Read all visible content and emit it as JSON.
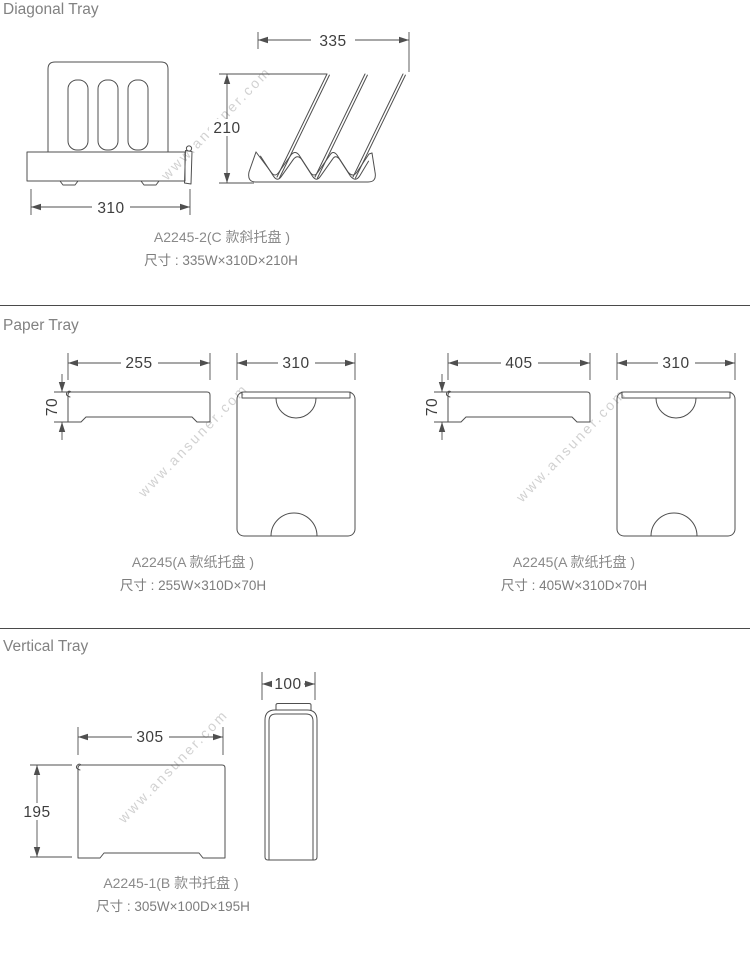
{
  "watermark": {
    "text": "www.ansuner.com"
  },
  "colors": {
    "line": "#4f4f4f",
    "dimension_text": "#3e3e3e",
    "title_text": "#828282",
    "caption_text": "#8a8a8a",
    "watermark": "#c9c9c9",
    "separator": "#4a4a4a",
    "background": "#ffffff"
  },
  "sections": [
    {
      "title": "Diagonal Tray",
      "caption": {
        "model": "A2245-2(C 款斜托盘 )",
        "size": "尺寸 : 335W×310D×210H"
      },
      "dims": {
        "side_width": "335",
        "side_height": "210",
        "front_width": "310"
      }
    },
    {
      "title": "Paper Tray",
      "items": [
        {
          "caption": {
            "model": "A2245(A 款纸托盘 )",
            "size": "尺寸 : 255W×310D×70H"
          },
          "dims": {
            "front_width": "255",
            "front_height": "70",
            "top_width": "310"
          }
        },
        {
          "caption": {
            "model": "A2245(A 款纸托盘 )",
            "size": "尺寸 : 405W×310D×70H"
          },
          "dims": {
            "front_width": "405",
            "front_height": "70",
            "top_width": "310"
          }
        }
      ]
    },
    {
      "title": "Vertical Tray",
      "caption": {
        "model": "A2245-1(B 款书托盘 )",
        "size": "尺寸 : 305W×100D×195H"
      },
      "dims": {
        "front_width": "305",
        "front_height": "195",
        "side_width": "100"
      }
    }
  ]
}
